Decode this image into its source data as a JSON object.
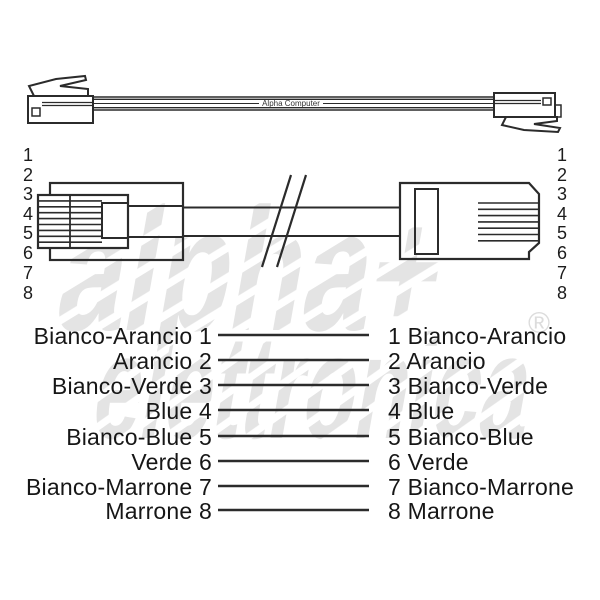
{
  "cable_label": {
    "text": "Alpha Computer"
  },
  "watermark": {
    "line1": "alpha+",
    "line2": "elettronica",
    "registered": "®"
  },
  "connector_pins": {
    "left": [
      "1",
      "2",
      "3",
      "4",
      "5",
      "6",
      "7",
      "8"
    ],
    "right": [
      "1",
      "2",
      "3",
      "4",
      "5",
      "6",
      "7",
      "8"
    ]
  },
  "wiring_rows": [
    {
      "left_label": "Bianco-Arancio 1",
      "right_label": "1 Bianco-Arancio"
    },
    {
      "left_label": "Arancio 2",
      "right_label": "2 Arancio"
    },
    {
      "left_label": "Bianco-Verde 3",
      "right_label": "3 Bianco-Verde"
    },
    {
      "left_label": "Blue 4",
      "right_label": "4 Blue"
    },
    {
      "left_label": "Bianco-Blue 5",
      "right_label": "5 Bianco-Blue"
    },
    {
      "left_label": "Verde 6",
      "right_label": "6 Verde"
    },
    {
      "left_label": "Bianco-Marrone 7",
      "right_label": "7 Bianco-Marrone"
    },
    {
      "left_label": "Marrone 8",
      "right_label": "8 Marrone"
    }
  ],
  "colors": {
    "line": "#2b2b2b",
    "text": "#1c1c1c",
    "watermark": "#e4e4e4",
    "background": "#ffffff"
  }
}
